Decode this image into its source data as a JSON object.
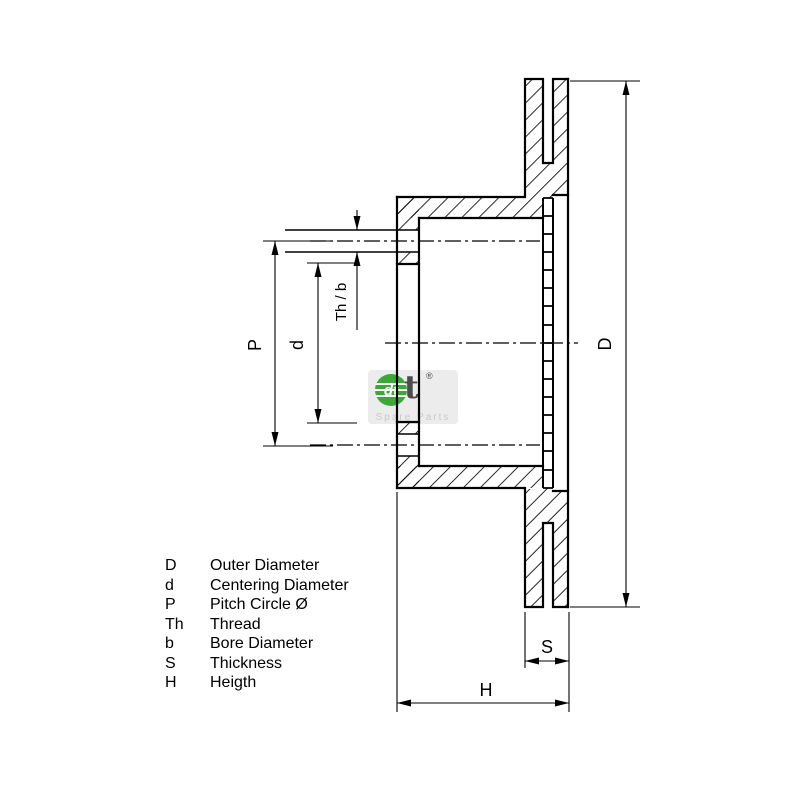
{
  "drawing": {
    "bg": "#ffffff",
    "line_color": "#000000",
    "dim_labels": {
      "D": "D",
      "P": "P",
      "d": "d",
      "th_b": "Th / b",
      "S": "S",
      "H": "H"
    }
  },
  "legend": {
    "rows": [
      {
        "symbol": "D",
        "label": "Outer Diameter"
      },
      {
        "symbol": "d",
        "label": "Centering Diameter"
      },
      {
        "symbol": "P",
        "label": "Pitch Circle Ø"
      },
      {
        "symbol": "Th",
        "label": "Thread"
      },
      {
        "symbol": "b",
        "label": "Bore Diameter"
      },
      {
        "symbol": "S",
        "label": "Thickness"
      },
      {
        "symbol": "H",
        "label": "Heigth"
      }
    ]
  },
  "watermark": {
    "logo_text": "dt",
    "registered": "®",
    "subtitle": "Spare Parts",
    "brand_green": "#3aaa35",
    "t_color": "#4c4c4c"
  }
}
